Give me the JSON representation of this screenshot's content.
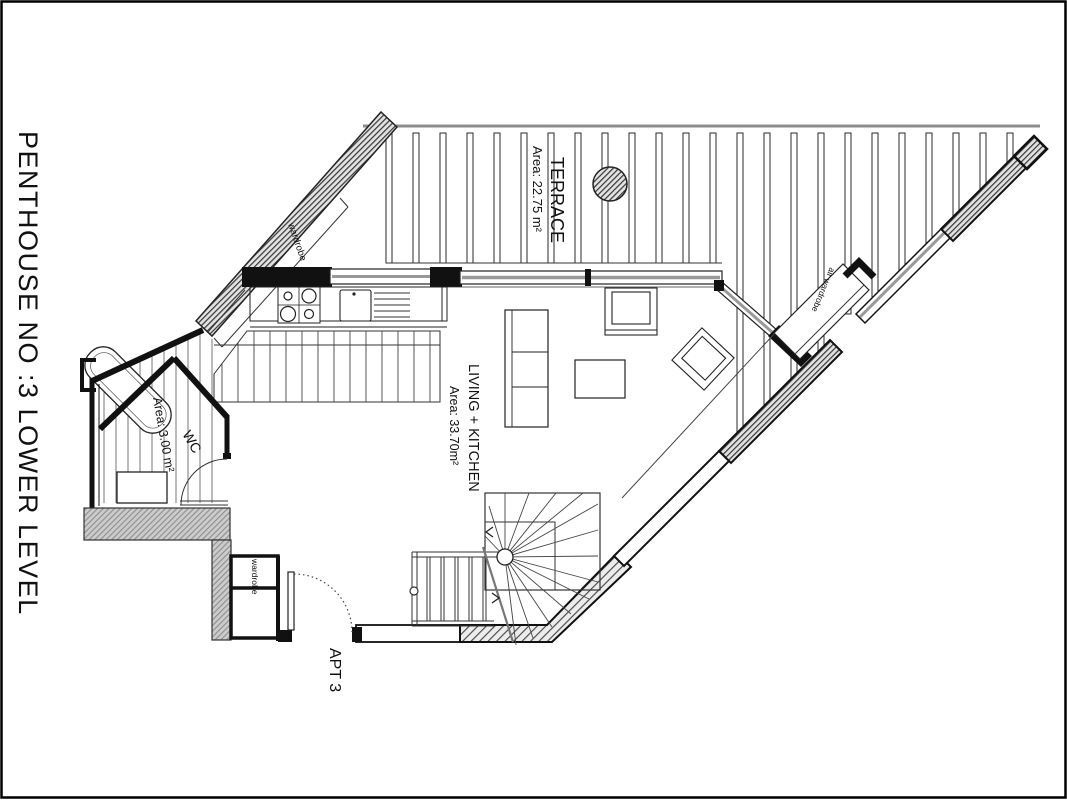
{
  "title": "PENTHOUSE NO :3  LOWER  LEVEL",
  "rooms": {
    "terrace": {
      "name": "TERRACE",
      "area": "Area: 22.75 m²"
    },
    "living": {
      "name": "LIVING + KITCHEN",
      "area": "Area: 33.70m²"
    },
    "wc": {
      "name": "WC",
      "area": "Area: 3.00 m²"
    }
  },
  "labels": {
    "apartment": "APT 3",
    "wardrobe_upper": "wardrobe",
    "wardrobe_lower": "wardrobe",
    "air_wardrobe": "air wardrobe"
  },
  "colors": {
    "line": "#1a1a1a",
    "glazing": "#999999",
    "deck_line": "#8c8c8c",
    "wall_gray": "#cccccc"
  }
}
